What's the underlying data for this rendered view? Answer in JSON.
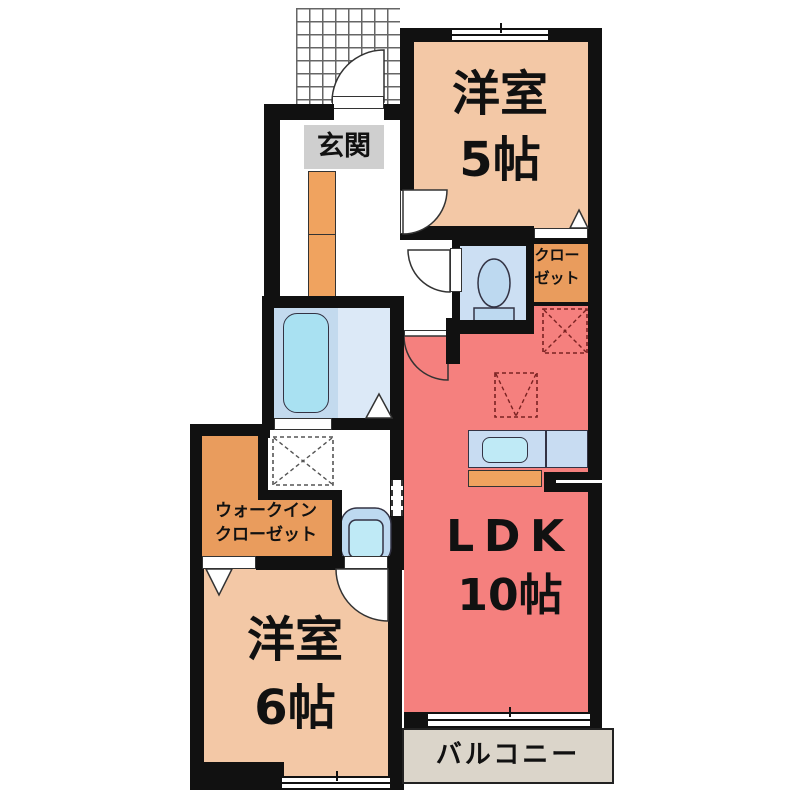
{
  "rooms": {
    "entrance": {
      "label": "玄関"
    },
    "western_room_5": {
      "name": "洋室",
      "size": "5帖"
    },
    "closet": {
      "line1": "クロー",
      "line2": "ゼット"
    },
    "ldk": {
      "name": "LDK",
      "size": "10帖"
    },
    "walk_in_closet": {
      "line1": "ウォークイン",
      "line2": "クローゼット"
    },
    "western_room_6": {
      "name": "洋室",
      "size": "6帖"
    },
    "balcony": {
      "label": "バルコニー"
    }
  },
  "colors": {
    "wall": "#111111",
    "room_peach": "#F3C8A6",
    "ldk_red": "#F5807E",
    "storage_orange": "#E99C5D",
    "cabinet_orange": "#F0A35F",
    "entrance_gray": "#CFCFCF",
    "balcony_beige": "#DBD5CA",
    "bath_blue": "#C3DAEE",
    "washroom_blue": "#DCE9F7",
    "toilet_blue": "#CCDFF3",
    "fixture_blue": "#BDD9F0",
    "counter_blue": "#C8DCF2",
    "water_cyan": "#A9E1F2",
    "sink_cyan": "#BFEAF6"
  }
}
